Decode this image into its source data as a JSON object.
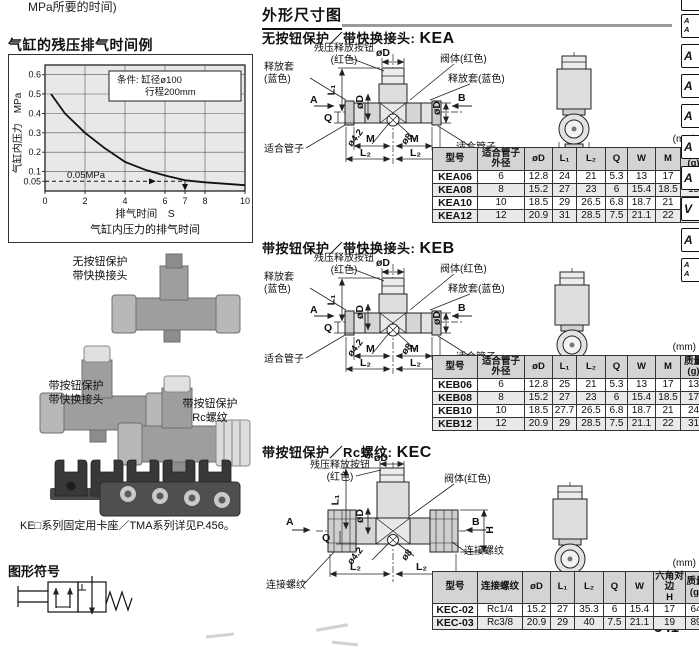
{
  "page": {
    "number": "541",
    "top_text": "MPa所要的时间)"
  },
  "tabs": [
    "",
    "A\nA",
    "A",
    "A",
    "A",
    "A",
    "A",
    "V",
    "A",
    "A\nA"
  ],
  "chart": {
    "title": "气缸的残压排气时间例",
    "condition1": "条件: 缸径ø100",
    "condition2": "行程200mm",
    "ylabel": "气缸内压力　MPa",
    "xlabel": "排气时间　S",
    "caption": "气缸内压力的排气时间",
    "annotation": "0.05MPa",
    "yticks": [
      "0.6",
      "0.5",
      "0.4",
      "0.3",
      "0.2",
      "0.1",
      "0.05"
    ],
    "xticks": [
      "0",
      "2",
      "4",
      "6",
      "7",
      "8",
      "10"
    ]
  },
  "chart_data": {
    "type": "line",
    "title": "气缸的残压排气时间例",
    "xlabel": "排气时间 S",
    "ylabel": "气缸内压力 MPa",
    "xlim": [
      0,
      10
    ],
    "ylim": [
      0,
      0.65
    ],
    "x_ticks": [
      0,
      2,
      4,
      6,
      7,
      8,
      10
    ],
    "y_ticks": [
      0.05,
      0.1,
      0.2,
      0.3,
      0.4,
      0.5,
      0.6
    ],
    "grid": true,
    "condition": "条件: 缸径ø100 行程200mm",
    "series": [
      {
        "name": "气缸内压力的排气时间",
        "x": [
          0.3,
          1,
          2,
          3,
          4,
          5,
          6,
          7,
          8,
          10
        ],
        "y": [
          0.5,
          0.4,
          0.3,
          0.22,
          0.15,
          0.11,
          0.08,
          0.055,
          0.045,
          0.03
        ]
      }
    ],
    "annotations": [
      {
        "text": "0.05MPa",
        "type": "dashed-horizontal-line",
        "y": 0.05,
        "x_end": 7
      }
    ]
  },
  "photos": {
    "kea_label": "无按钮保护\n带快换接头",
    "keb_label": "带按钮保护\n带快换接头",
    "kec_label": "带按钮保护\nRc螺纹",
    "caption": "KE□系列固定用卡座／TMA系列详见P.456。"
  },
  "symbol": {
    "heading": "图形符号"
  },
  "outline": {
    "heading": "外形尺寸图",
    "kea_prefix": "无按钮保护／带快换接头: ",
    "kea_code": "KEA",
    "keb_prefix": "带按钮保护／带快换接头: ",
    "keb_code": "KEB",
    "kec_prefix": "带按钮保护／Rc螺纹: ",
    "kec_code": "KEC"
  },
  "diagrams": {
    "kea": {
      "button": "残压释放按钮\n(红色)",
      "valve": "阀体(红色)",
      "sleeve_left": "释放套\n(蓝色)",
      "sleeve_right": "释放套(蓝色)",
      "tube_left": "适合管子",
      "tube_right": "适合管子",
      "a": "A",
      "b": "B",
      "q": "Q",
      "l1": "L₁",
      "od": "øD",
      "od_side": "øD",
      "od_right": "øD",
      "d1": "ø4.2",
      "d2": "ø8",
      "m": "M",
      "l2": "L₂",
      "w": "W"
    },
    "keb": {
      "button": "残压释放按钮\n(红色)",
      "valve": "阀体(红色)",
      "sleeve_left": "释放套\n(蓝色)",
      "sleeve_right": "释放套(蓝色)",
      "tube_left": "适合管子",
      "tube_right": "适合管子",
      "a": "A",
      "b": "B",
      "q": "Q",
      "l1": "L₁",
      "od": "øD",
      "od_side": "øD",
      "od_right": "øD",
      "d1": "ø4.2",
      "d2": "ø8",
      "m": "M",
      "l2": "L₂",
      "w": "W"
    },
    "kec": {
      "button": "残压释放按钮\n(红色)",
      "valve": "阀体(红色)",
      "thread_left": "连接螺纹",
      "thread_right": "连接螺纹",
      "a": "A",
      "b": "B",
      "q": "Q",
      "h": "H",
      "l1": "L₁",
      "od": "øD",
      "od_side": "øD",
      "d1": "ø4.2",
      "d2": "ø8",
      "l2": "L₂",
      "w": "W"
    }
  },
  "tables": {
    "unit": "(mm)",
    "kea": {
      "headers": [
        "型号",
        "适合管子\n外径",
        "øD",
        "L₁",
        "L₂",
        "Q",
        "W",
        "M",
        "质量\n(g)"
      ],
      "rows": [
        [
          "KEA06",
          "6",
          "12.8",
          "24",
          "21",
          "5.3",
          "13",
          "17",
          "10"
        ],
        [
          "KEA08",
          "8",
          "15.2",
          "27",
          "23",
          "6",
          "15.4",
          "18.5",
          "15"
        ],
        [
          "KEA10",
          "10",
          "18.5",
          "29",
          "26.5",
          "6.8",
          "18.7",
          "21",
          "22.5"
        ],
        [
          "KEA12",
          "12",
          "20.9",
          "31",
          "28.5",
          "7.5",
          "21.1",
          "22",
          "29.5"
        ]
      ]
    },
    "keb": {
      "headers": [
        "型号",
        "适合管子\n外径",
        "øD",
        "L₁",
        "L₂",
        "Q",
        "W",
        "M",
        "质量\n(g)"
      ],
      "rows": [
        [
          "KEB06",
          "6",
          "12.8",
          "25",
          "21",
          "5.3",
          "13",
          "17",
          "13"
        ],
        [
          "KEB08",
          "8",
          "15.2",
          "27",
          "23",
          "6",
          "15.4",
          "18.5",
          "17"
        ],
        [
          "KEB10",
          "10",
          "18.5",
          "27.7",
          "26.5",
          "6.8",
          "18.7",
          "21",
          "24"
        ],
        [
          "KEB12",
          "12",
          "20.9",
          "29",
          "28.5",
          "7.5",
          "21.1",
          "22",
          "31"
        ]
      ]
    },
    "kec": {
      "headers": [
        "型号",
        "连接螺纹",
        "øD",
        "L₁",
        "L₂",
        "Q",
        "W",
        "六角对边\nH",
        "质量\n(g)"
      ],
      "rows": [
        [
          "KEC-02",
          "Rc1/4",
          "15.2",
          "27",
          "35.3",
          "6",
          "15.4",
          "17",
          "64"
        ],
        [
          "KEC-03",
          "Rc3/8",
          "20.9",
          "29",
          "40",
          "7.5",
          "21.1",
          "19",
          "89"
        ]
      ]
    }
  }
}
